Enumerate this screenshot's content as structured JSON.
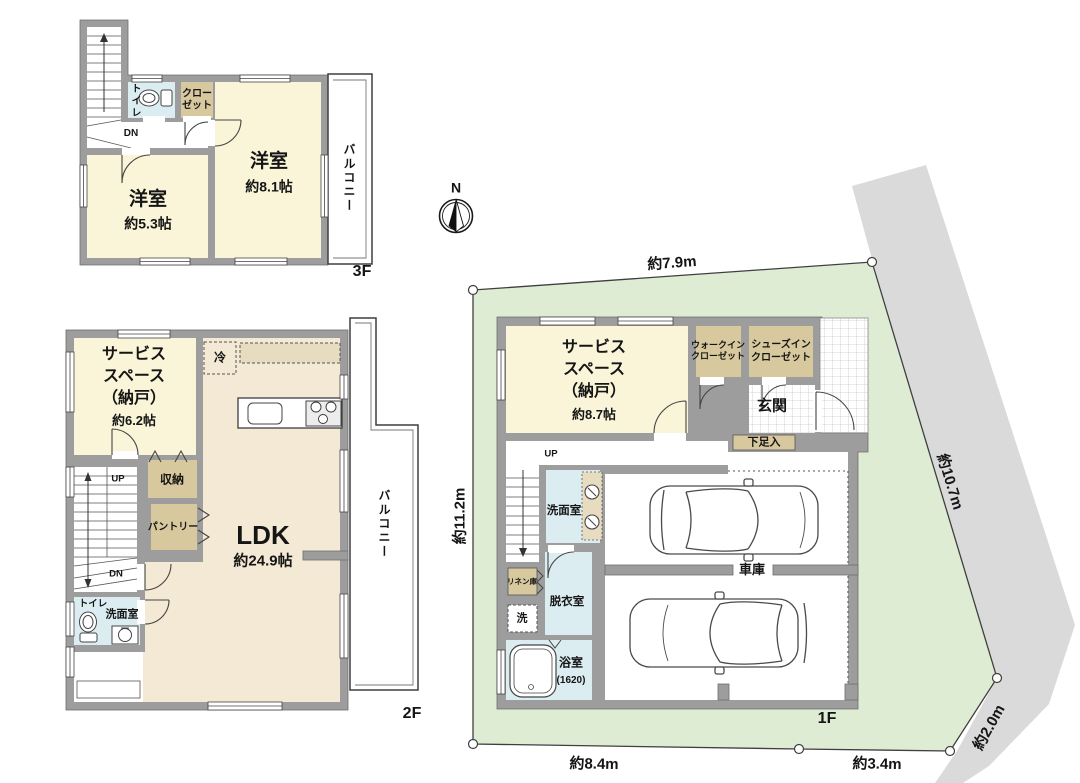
{
  "site": {
    "north_label": "N",
    "dims": {
      "top": "約7.9m",
      "left": "約11.2m",
      "right": "約10.7m",
      "bottom_left": "約8.4m",
      "bottom_right": "約3.4m",
      "corner": "約2.0m"
    }
  },
  "floor3": {
    "label": "3F",
    "balcony": "バルコニー",
    "toilet": "トイレ",
    "closet": "クロー\nゼット",
    "dn": "DN",
    "room_81": {
      "name": "洋室",
      "area": "約8.1帖"
    },
    "room_53": {
      "name": "洋室",
      "area": "約5.3帖"
    }
  },
  "floor2": {
    "label": "2F",
    "balcony": "バルコニー",
    "up": "UP",
    "dn": "DN",
    "fridge": "冷",
    "storage": "収納",
    "pantry": "パントリー",
    "toilet": "トイレ",
    "washroom": "洗面室",
    "service": {
      "name": "サービス\nスペース\n（納戸）",
      "area": "約6.2帖"
    },
    "ldk": {
      "name": "LDK",
      "area": "約24.9帖"
    }
  },
  "floor1": {
    "label": "1F",
    "up": "UP",
    "service": {
      "name": "サービス\nスペース\n（納戸）",
      "area": "約8.7帖"
    },
    "wic": "ウォークイン\nクローゼット",
    "sic": "シューズイン\nクローゼット",
    "entrance": "玄関",
    "shoe_box": "下足入",
    "washroom": "洗面室",
    "dressing": "脱衣室",
    "linen": "リネン庫",
    "laundry": "洗",
    "bath": {
      "name": "浴室",
      "size": "(1620)"
    },
    "garage": "車庫"
  },
  "colors": {
    "wall": "#9d9d9d",
    "room_cream": "#faf5d8",
    "floor_beige": "#f3e9d5",
    "closet_tan": "#d8c89e",
    "wet_blue": "#dbedf1",
    "site_green": "#dfecd4",
    "road_gray": "#dadada",
    "outline": "#3f3f3f"
  }
}
